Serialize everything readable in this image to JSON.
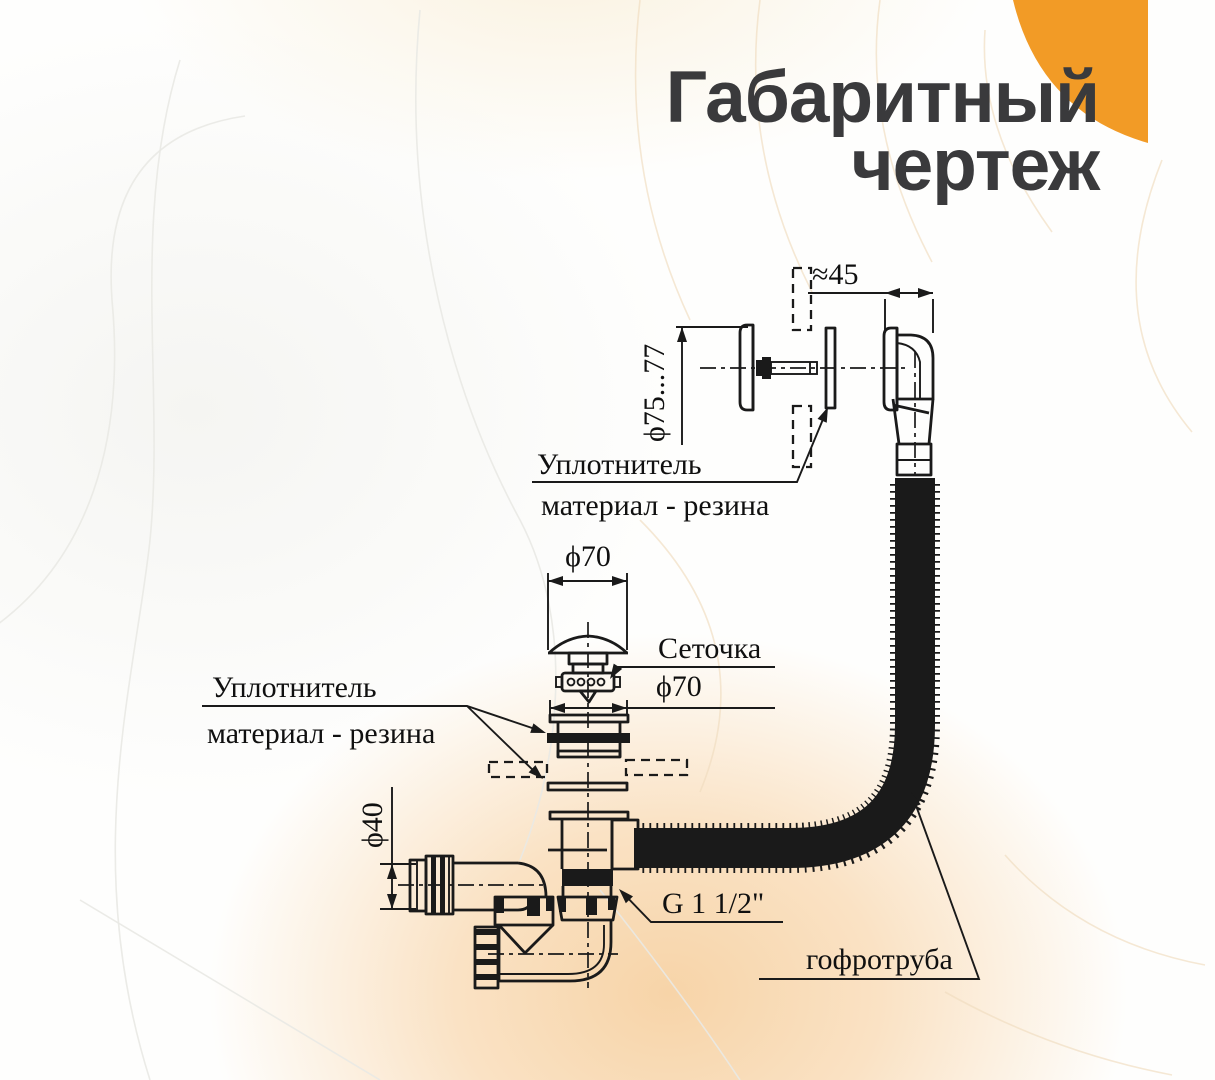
{
  "title": {
    "line1": "Габаритный",
    "line2": "чертеж"
  },
  "drawing": {
    "dimensions": {
      "overflow_offset": "≈45",
      "overflow_plate_diameter": "ϕ75...77",
      "cap_diameter": "ϕ70",
      "flange_diameter": "ϕ70",
      "outlet_pipe_diameter": "ϕ40",
      "thread_size": "G 1 1/2\""
    },
    "callouts": {
      "seal_upper_title": "Уплотнитель",
      "seal_upper_material": "материал - резина",
      "seal_lower_title": "Уплотнитель",
      "seal_lower_material": "материал - резина",
      "strainer": "Сеточка",
      "corrugated_pipe": "гофротруба"
    }
  },
  "colors": {
    "accent_orange": "#F29B26",
    "line_color": "#1A1A1A",
    "title_color": "#3A3A3C",
    "peach_glow": "#F7D4A8"
  }
}
